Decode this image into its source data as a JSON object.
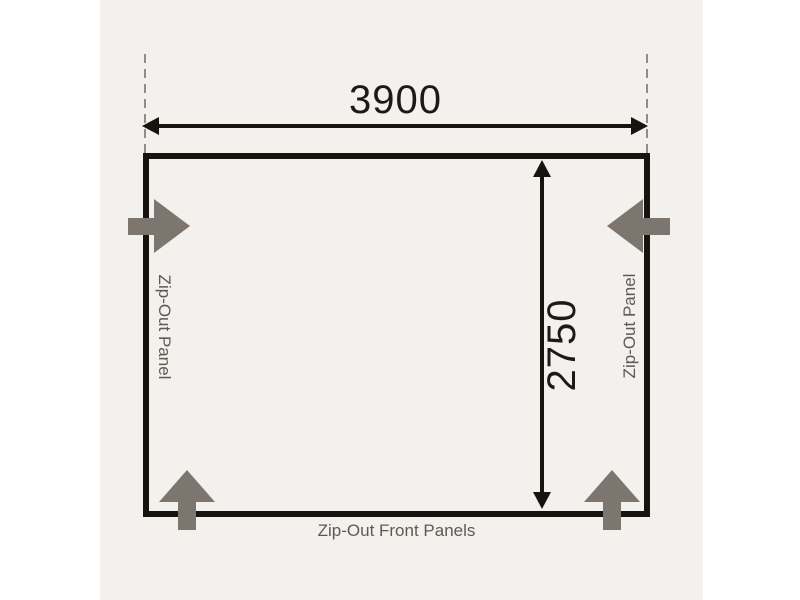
{
  "diagram": {
    "dimensions": {
      "width": {
        "value": "3900"
      },
      "depth": {
        "value": "2750"
      }
    },
    "labels": {
      "left_panel": "Zip-Out Panel",
      "right_panel": "Zip-Out Panel",
      "front_panels": "Zip-Out Front Panels"
    },
    "colors": {
      "canvas": "#ffffff",
      "panel_background": "#f2f1ee",
      "outline": "#17130e",
      "dimension_text": "#1c1916",
      "dashed_guide": "#8d8d8d",
      "zip_arrow": "#7d766e",
      "label_text": "#5f5953"
    }
  }
}
